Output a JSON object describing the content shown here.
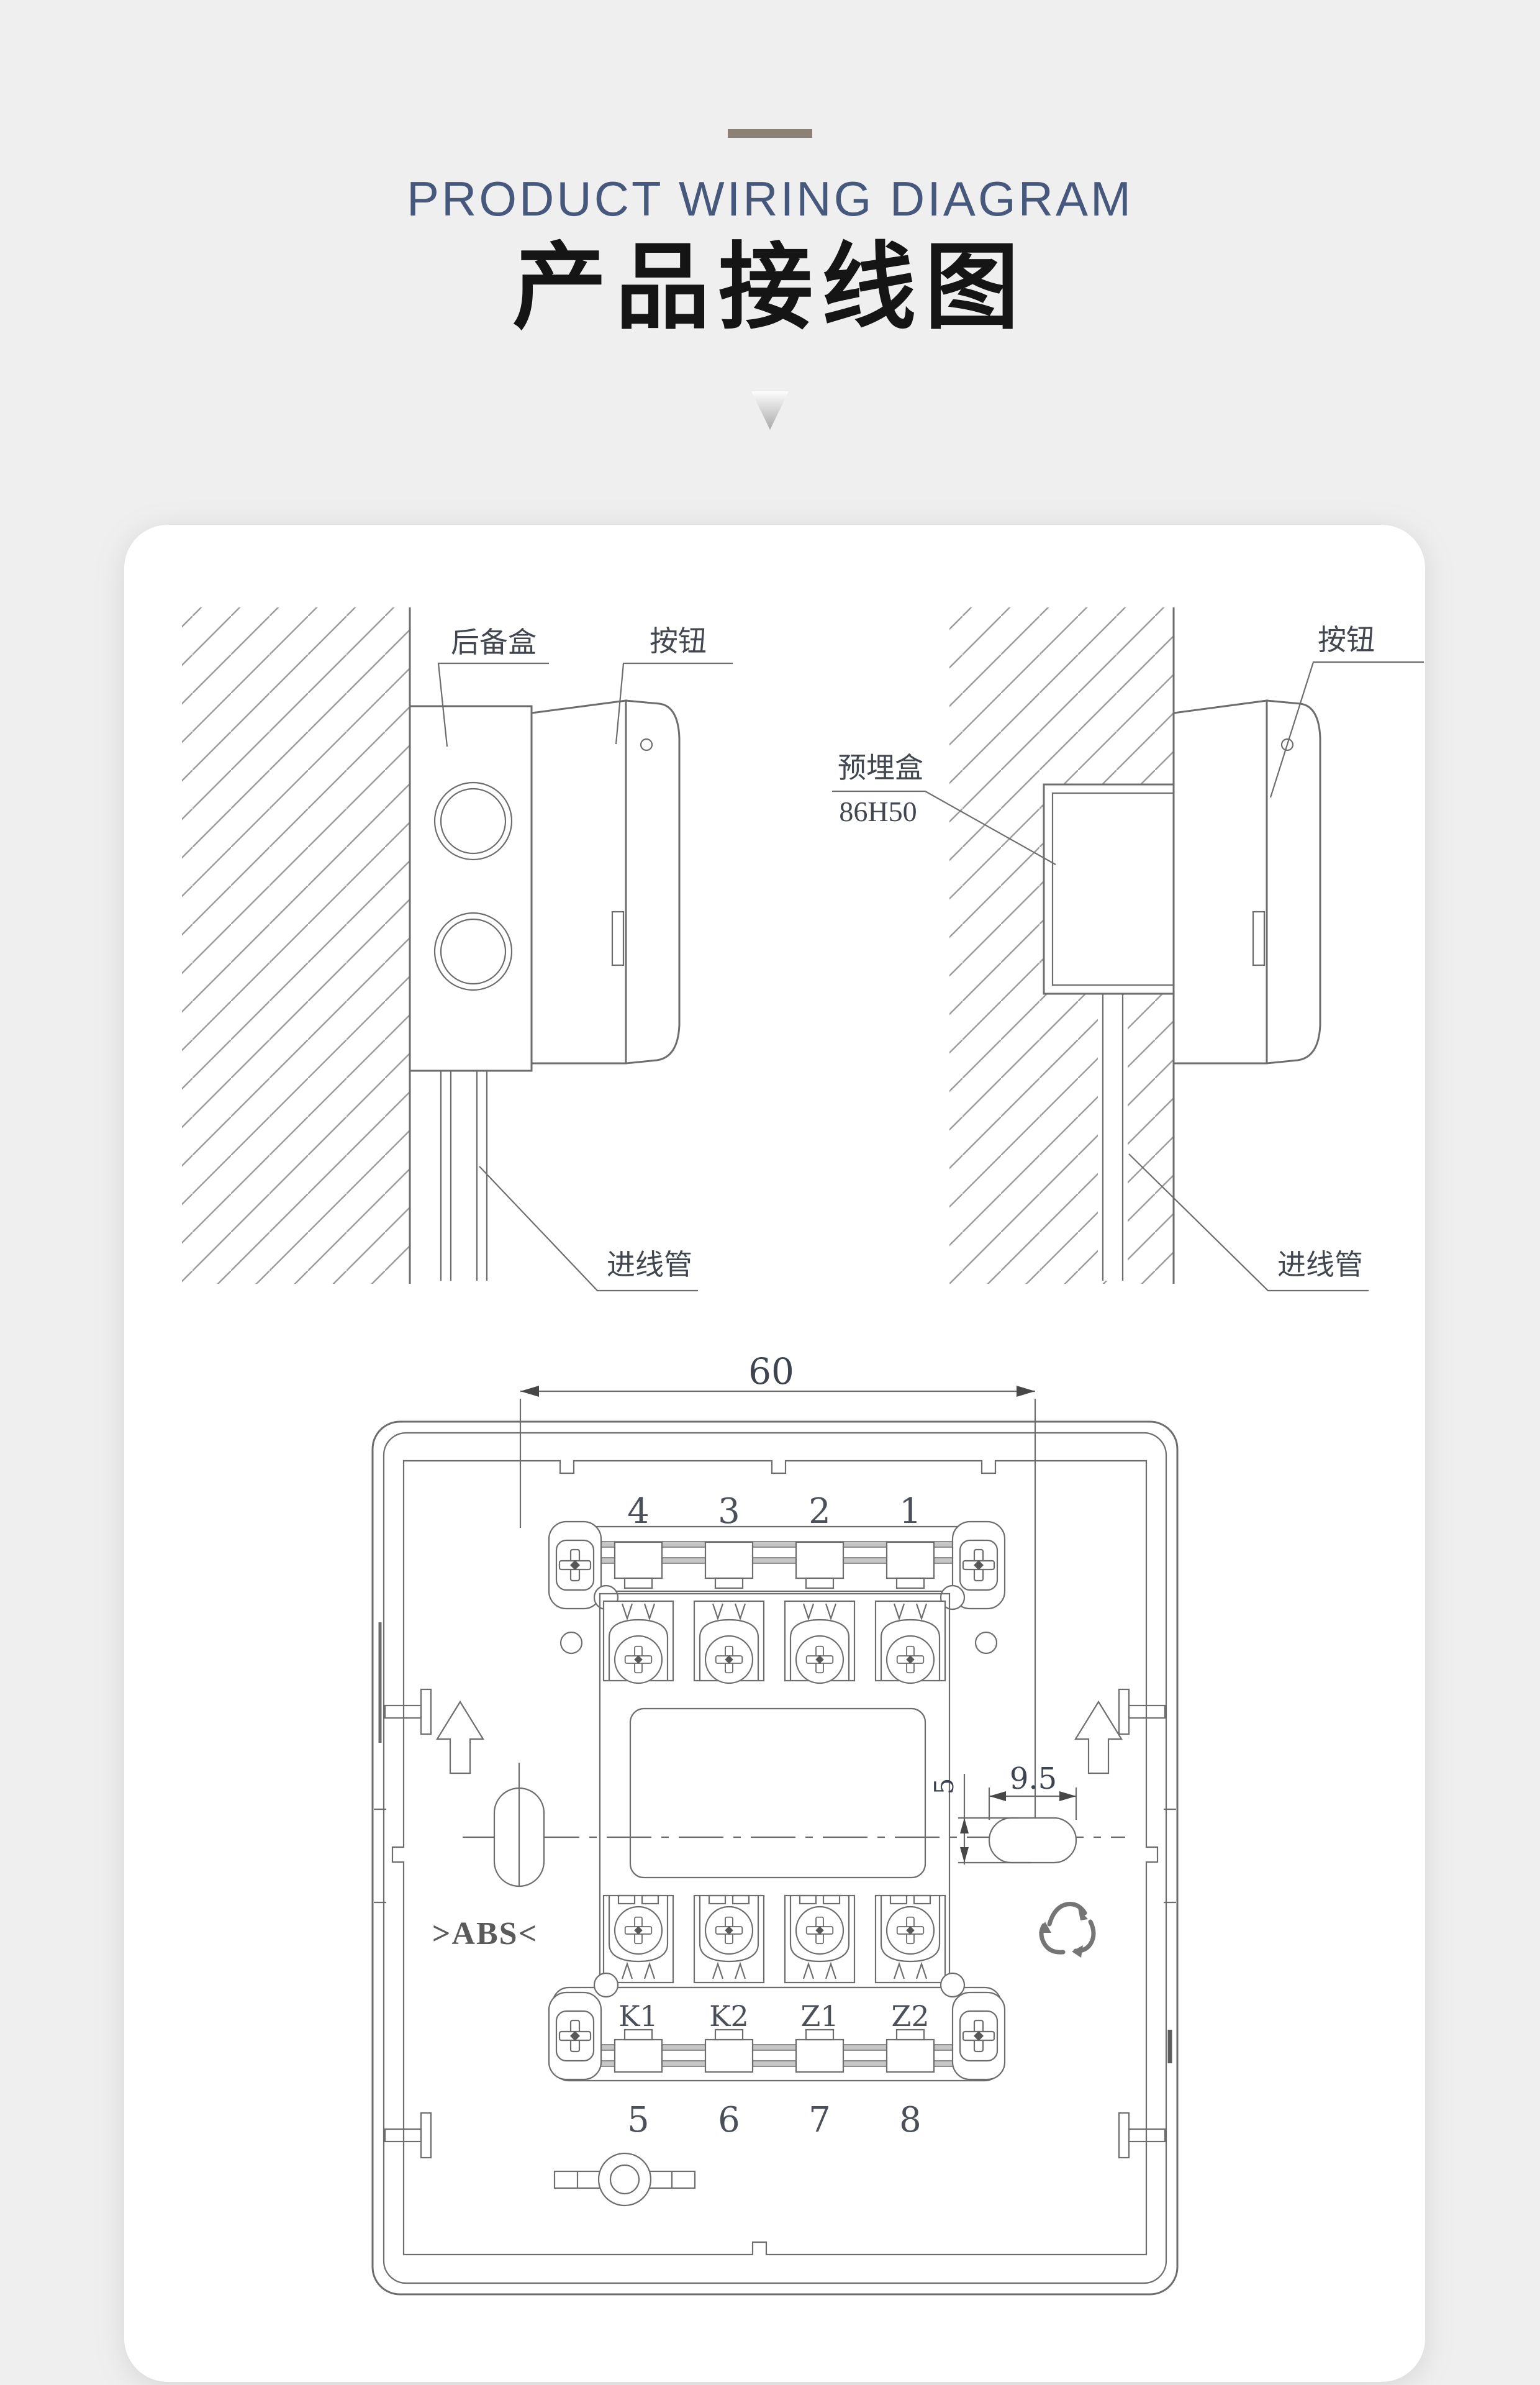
{
  "header": {
    "title_en": "PRODUCT WIRING DIAGRAM",
    "title_cn": "产品接线图"
  },
  "views": {
    "surface": {
      "backup_box": "后备盒",
      "button": "按钮",
      "inlet_pipe": "进线管"
    },
    "flush": {
      "button": "按钮",
      "embedded_box": "预埋盒",
      "embedded_box_model": "86H50",
      "inlet_pipe": "进线管"
    }
  },
  "panel": {
    "dim_width": "60",
    "dim_hole_width": "9.5",
    "dim_hole_height": "5",
    "top_numbers": [
      "4",
      "3",
      "2",
      "1"
    ],
    "terminal_labels": [
      "K1",
      "K2",
      "Z1",
      "Z2"
    ],
    "bottom_numbers": [
      "5",
      "6",
      "7",
      "8"
    ],
    "material_mark": ">ABS<"
  },
  "colors": {
    "title_en": "#46587c",
    "title_cn": "#151515",
    "line": "#6d6d6d",
    "background": "#efefef",
    "card": "#ffffff"
  }
}
